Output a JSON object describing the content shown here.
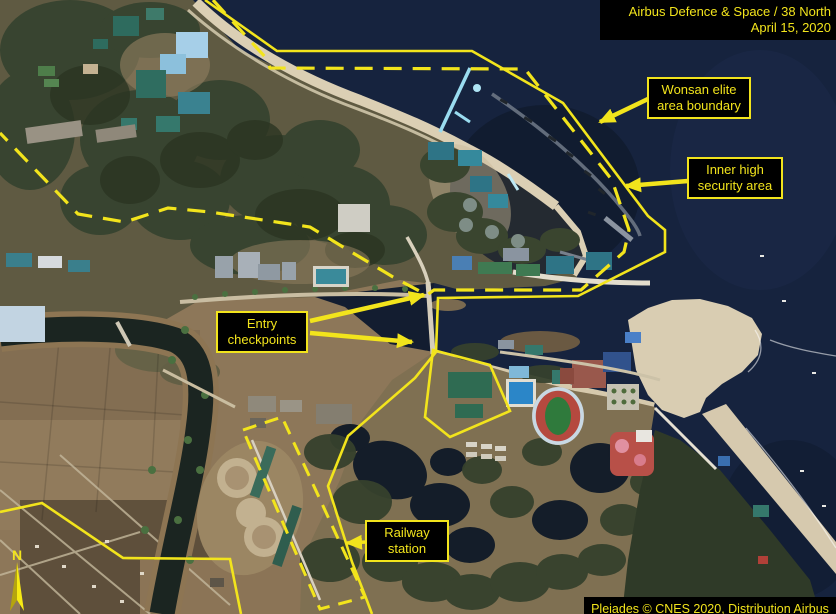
{
  "credits": {
    "top_line1": "Airbus Defence & Space / 38 North",
    "top_line2": "April 15, 2020",
    "bottom_line": "Pleiades © CNES 2020, Distribution Airbus DS"
  },
  "labels": {
    "wonsan": {
      "line1": "Wonsan elite",
      "line2": "area boundary"
    },
    "inner": {
      "line1": "Inner high",
      "line2": "security area"
    },
    "entry": {
      "line1": "Entry",
      "line2": "checkpoints"
    },
    "railway": {
      "line1": "Railway",
      "line2": "station"
    }
  },
  "compass": {
    "north_label": "N"
  },
  "colors": {
    "annotation_yellow": "#f2e41c",
    "label_background": "#000000",
    "sea": "#16233e",
    "sand": "#d9cdb2",
    "forest": "#333e29",
    "fields": "#8d7759",
    "stadium_track": "#b5493f",
    "stadium_field": "#2f7a3c",
    "pool_blue": "#2b86c8"
  }
}
